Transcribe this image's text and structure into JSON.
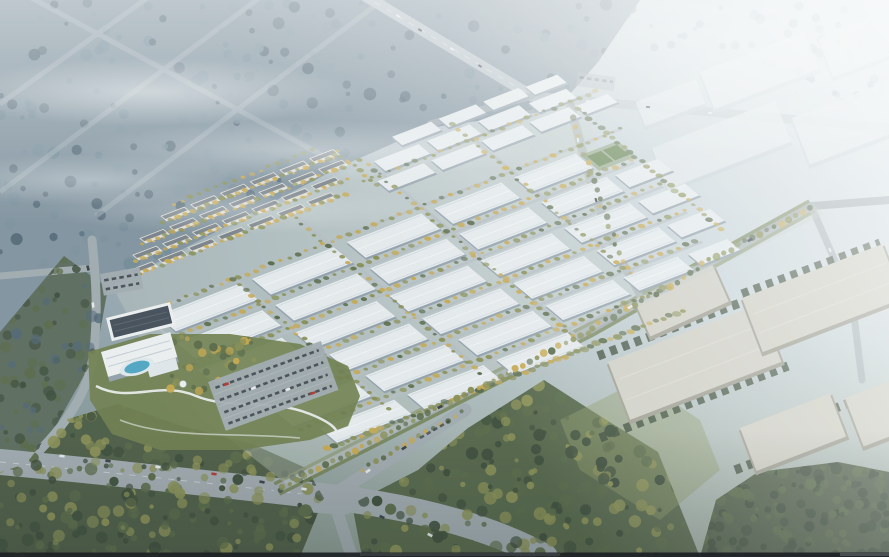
{
  "scene": {
    "description": "Aerial architectural rendering of a planned industrial park: a diagonal grid of white factory halls with tree-lined internal roads, rows of residential apartment blocks and a hotel with landscaped garden and pool on the west side, large warm-gray logistics warehouses to the southeast, misty forest with highways at the top left, hazy distant halls at the top right, and a major road intersection with traffic at the bottom.",
    "regions": [
      "forest-top-left",
      "highway-junction",
      "factory-grid",
      "residential-rows",
      "hotel-and-garden",
      "parking-lots",
      "green-boundary-belt",
      "logistics-warehouses",
      "distant-hazy-halls",
      "bottom-intersection",
      "forest-bottom",
      "sports-courts"
    ]
  },
  "palette": {
    "sky-top-left": "#8799a5",
    "sky-top-right": "#dce4e8",
    "roof-white": "#e9edf0",
    "roof-ridge": "#f6f8f9",
    "wall-shadow": "#96a3ae",
    "road-gray": "#a4adb3",
    "road-light": "#b7c0c6",
    "grass-green": "#72804f",
    "grass-light": "#8f9a66",
    "tree-dark": "#3e4d3b",
    "tree-green": "#5b6b49",
    "tree-olive": "#8c9156",
    "tree-gold": "#c9a94f",
    "tree-mist-dark": "#546876",
    "tree-mist-light": "#7e93a0",
    "forest-mist": "#758c9a",
    "res-wall": "#e3e1d8",
    "res-roof": "#7d848d",
    "res-glow": "#e9b45c",
    "hotel-white": "#f0f2f3",
    "dark-roof": "#47505a",
    "pool-blue": "#52a8c6",
    "wh-roof": "#d4d2c7",
    "wh-wall": "#a19f92",
    "hz-roof": "#e3e8eb",
    "hz-wall": "#c6d0d6",
    "car-white": "#e9ebed",
    "car-dark": "#3b4248",
    "car-red": "#b23a33",
    "court-green": "#5e7d46",
    "bottom-bar": "#1e2225"
  }
}
